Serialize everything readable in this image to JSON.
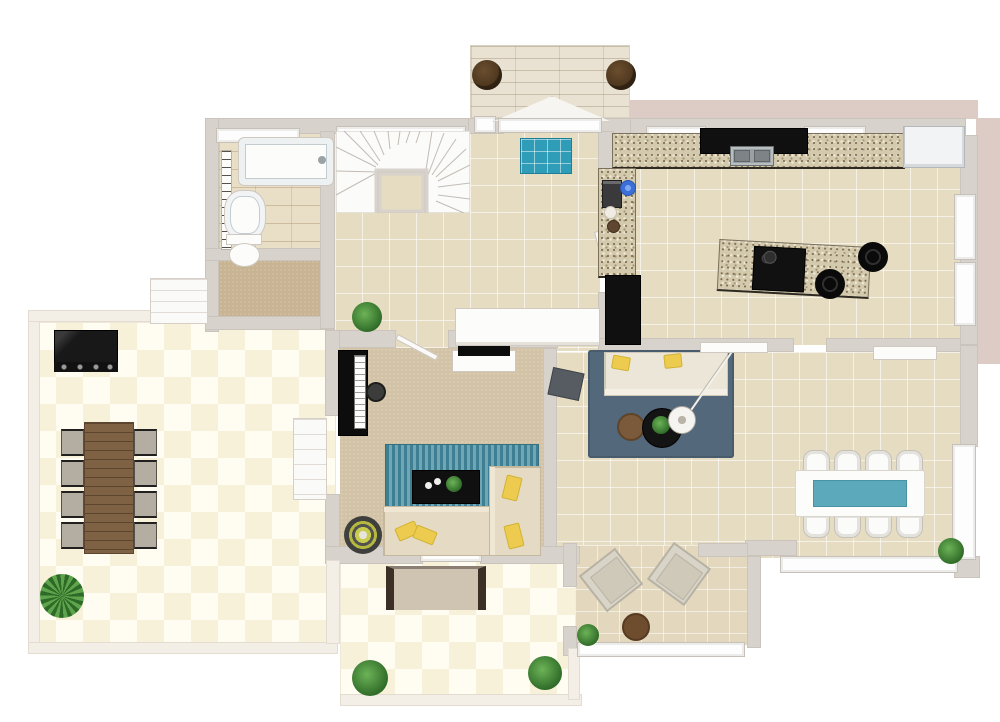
{
  "page": {
    "type": "3d-floor-plan-top-view",
    "visible_text": "",
    "style": "photorealistic rendered floor plan, single storey, white exterior"
  },
  "colors": {
    "wall": "#d8d2cc",
    "exterior_accent": "#ddccc6",
    "floor_tile_beige": "#e5dcc1",
    "floor_checker_cream": "#f8f1d9",
    "carpet_tan": "#d3c3a6",
    "granite_counter": "#d3c9ad",
    "rug_blue": "#53687b",
    "rug_teal_stripe": "#3f7f93",
    "doormat_teal": "#2f9cb8",
    "dining_glass_teal": "#5ba9ba",
    "pillow_yellow": "#eccb4f",
    "wood_table_brown": "#7f6143",
    "plant_green": "#3f8534",
    "appliance_black": "#101010"
  },
  "rooms": {
    "patio": {
      "label": "Patio terrace",
      "floor": "cream checkerboard tile",
      "furniture": [
        "bbq grill",
        "wooden outdoor dining table",
        "8 outdoor chairs",
        "palm plant",
        "garden steps"
      ]
    },
    "bathroom": {
      "label": "Bathroom",
      "floor": "stone tile",
      "furniture": [
        "bathtub",
        "washbasin",
        "toilet",
        "towel radiator"
      ]
    },
    "closet": {
      "label": "Closet room",
      "floor": "brown carpet",
      "furniture": []
    },
    "stairs": {
      "label": "Winder staircase",
      "floor": "white treads",
      "furniture": []
    },
    "hall": {
      "label": "Entry hall",
      "floor": "beige tile",
      "furniture": [
        "blue doormat",
        "white sideboard",
        "green plant"
      ]
    },
    "family_room": {
      "label": "Family room",
      "floor": "tan carpet",
      "furniture": [
        "grand piano",
        "piano stool",
        "tv stand with tv",
        "teal striped rug",
        "black coffee table",
        "l-shaped beige sectional sofa",
        "yellow pillows",
        "round target rug"
      ]
    },
    "kitchen": {
      "label": "Kitchen",
      "floor": "beige tile",
      "furniture": [
        "granite l-counter",
        "black cooktop counter with double sink",
        "refrigerator",
        "granite island with cooktop",
        "2 bar stools",
        "tall black cabinet",
        "coffee machine",
        "blue bowl",
        "canisters"
      ]
    },
    "living_room": {
      "label": "Living room",
      "floor": "beige tile",
      "furniture": [
        "blue area rug",
        "cream three-seat sofa",
        "yellow pillows",
        "gray ottoman",
        "black round coffee table",
        "brown round side table",
        "arc floor lamp",
        "white console"
      ]
    },
    "dining_area": {
      "label": "Dining area",
      "floor": "beige tile",
      "furniture": [
        "white dining table with teal glass inlay",
        "8 white chairs",
        "potted plant",
        "white console"
      ]
    },
    "sunroom": {
      "label": "Sunroom lounge",
      "floor": "tan tile",
      "furniture": [
        "2 angled lounge chairs",
        "round wooden table",
        "bush plant"
      ]
    },
    "porch": {
      "label": "Rear porch",
      "floor": "cream checkerboard tile",
      "furniture": [
        "cushioned bench",
        "2 bushes"
      ]
    },
    "deck": {
      "label": "Entry deck",
      "floor": "whitewashed wood planks",
      "furniture": [
        "2 round planters",
        "gabled door canopy"
      ]
    }
  }
}
